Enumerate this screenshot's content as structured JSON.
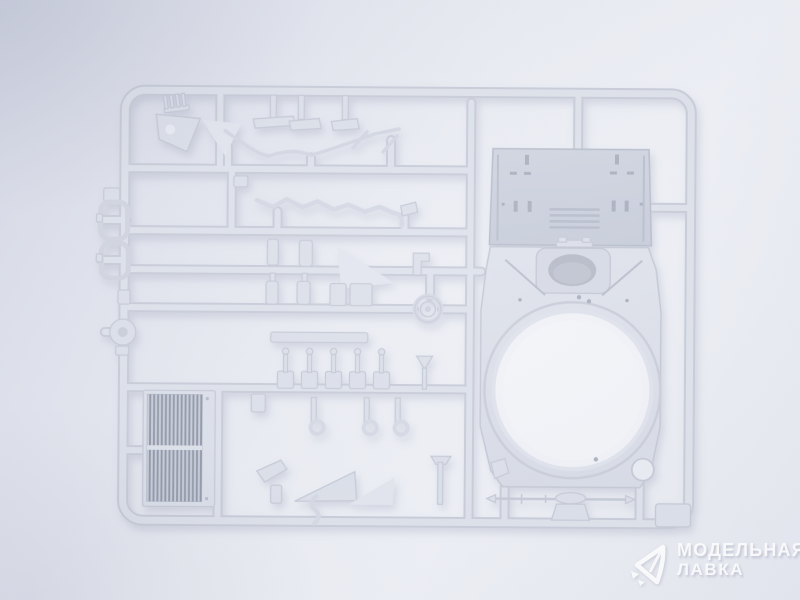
{
  "meta": {
    "type": "product-photo",
    "subject": "light gray injection-molded plastic model kit sprue on a pale studio background"
  },
  "palette": {
    "background_corner": "#d4d8e5",
    "background_center": "#eef0f6",
    "plastic_base": "#dbdfe9",
    "plastic_edge": "#c6cbd7",
    "deck_plate": "#ccd1dd",
    "dark_slot": "#a9afbe",
    "grille_slats": "#8d94a6",
    "oval_hole_shadow": "#b5bac7",
    "ring_hole_light": "#f0f2f7",
    "watermark_text": "#ffffff"
  },
  "sprue": {
    "parts": [
      {
        "name": "engine-deck-panel"
      },
      {
        "name": "turret-roof-panel-with-ring-opening"
      },
      {
        "name": "oval-hatch-opening"
      },
      {
        "name": "radiator-grille"
      },
      {
        "name": "fender-strips"
      },
      {
        "name": "zigzag-track-guard-strip"
      },
      {
        "name": "triangular-brackets"
      },
      {
        "name": "hatch-ring"
      },
      {
        "name": "small-cylinders-and-boxes"
      },
      {
        "name": "pin-fittings-row"
      },
      {
        "name": "hook-fittings"
      },
      {
        "name": "tow-rod"
      },
      {
        "name": "pulley-wheel"
      },
      {
        "name": "periscope-frames"
      },
      {
        "name": "corner-tab"
      }
    ]
  },
  "watermark": {
    "line1": "МОДЕЛЬНАЯ",
    "line2": "ЛАВКА",
    "logo": "gem-arrows-logo",
    "text_color": "#ffffff"
  }
}
